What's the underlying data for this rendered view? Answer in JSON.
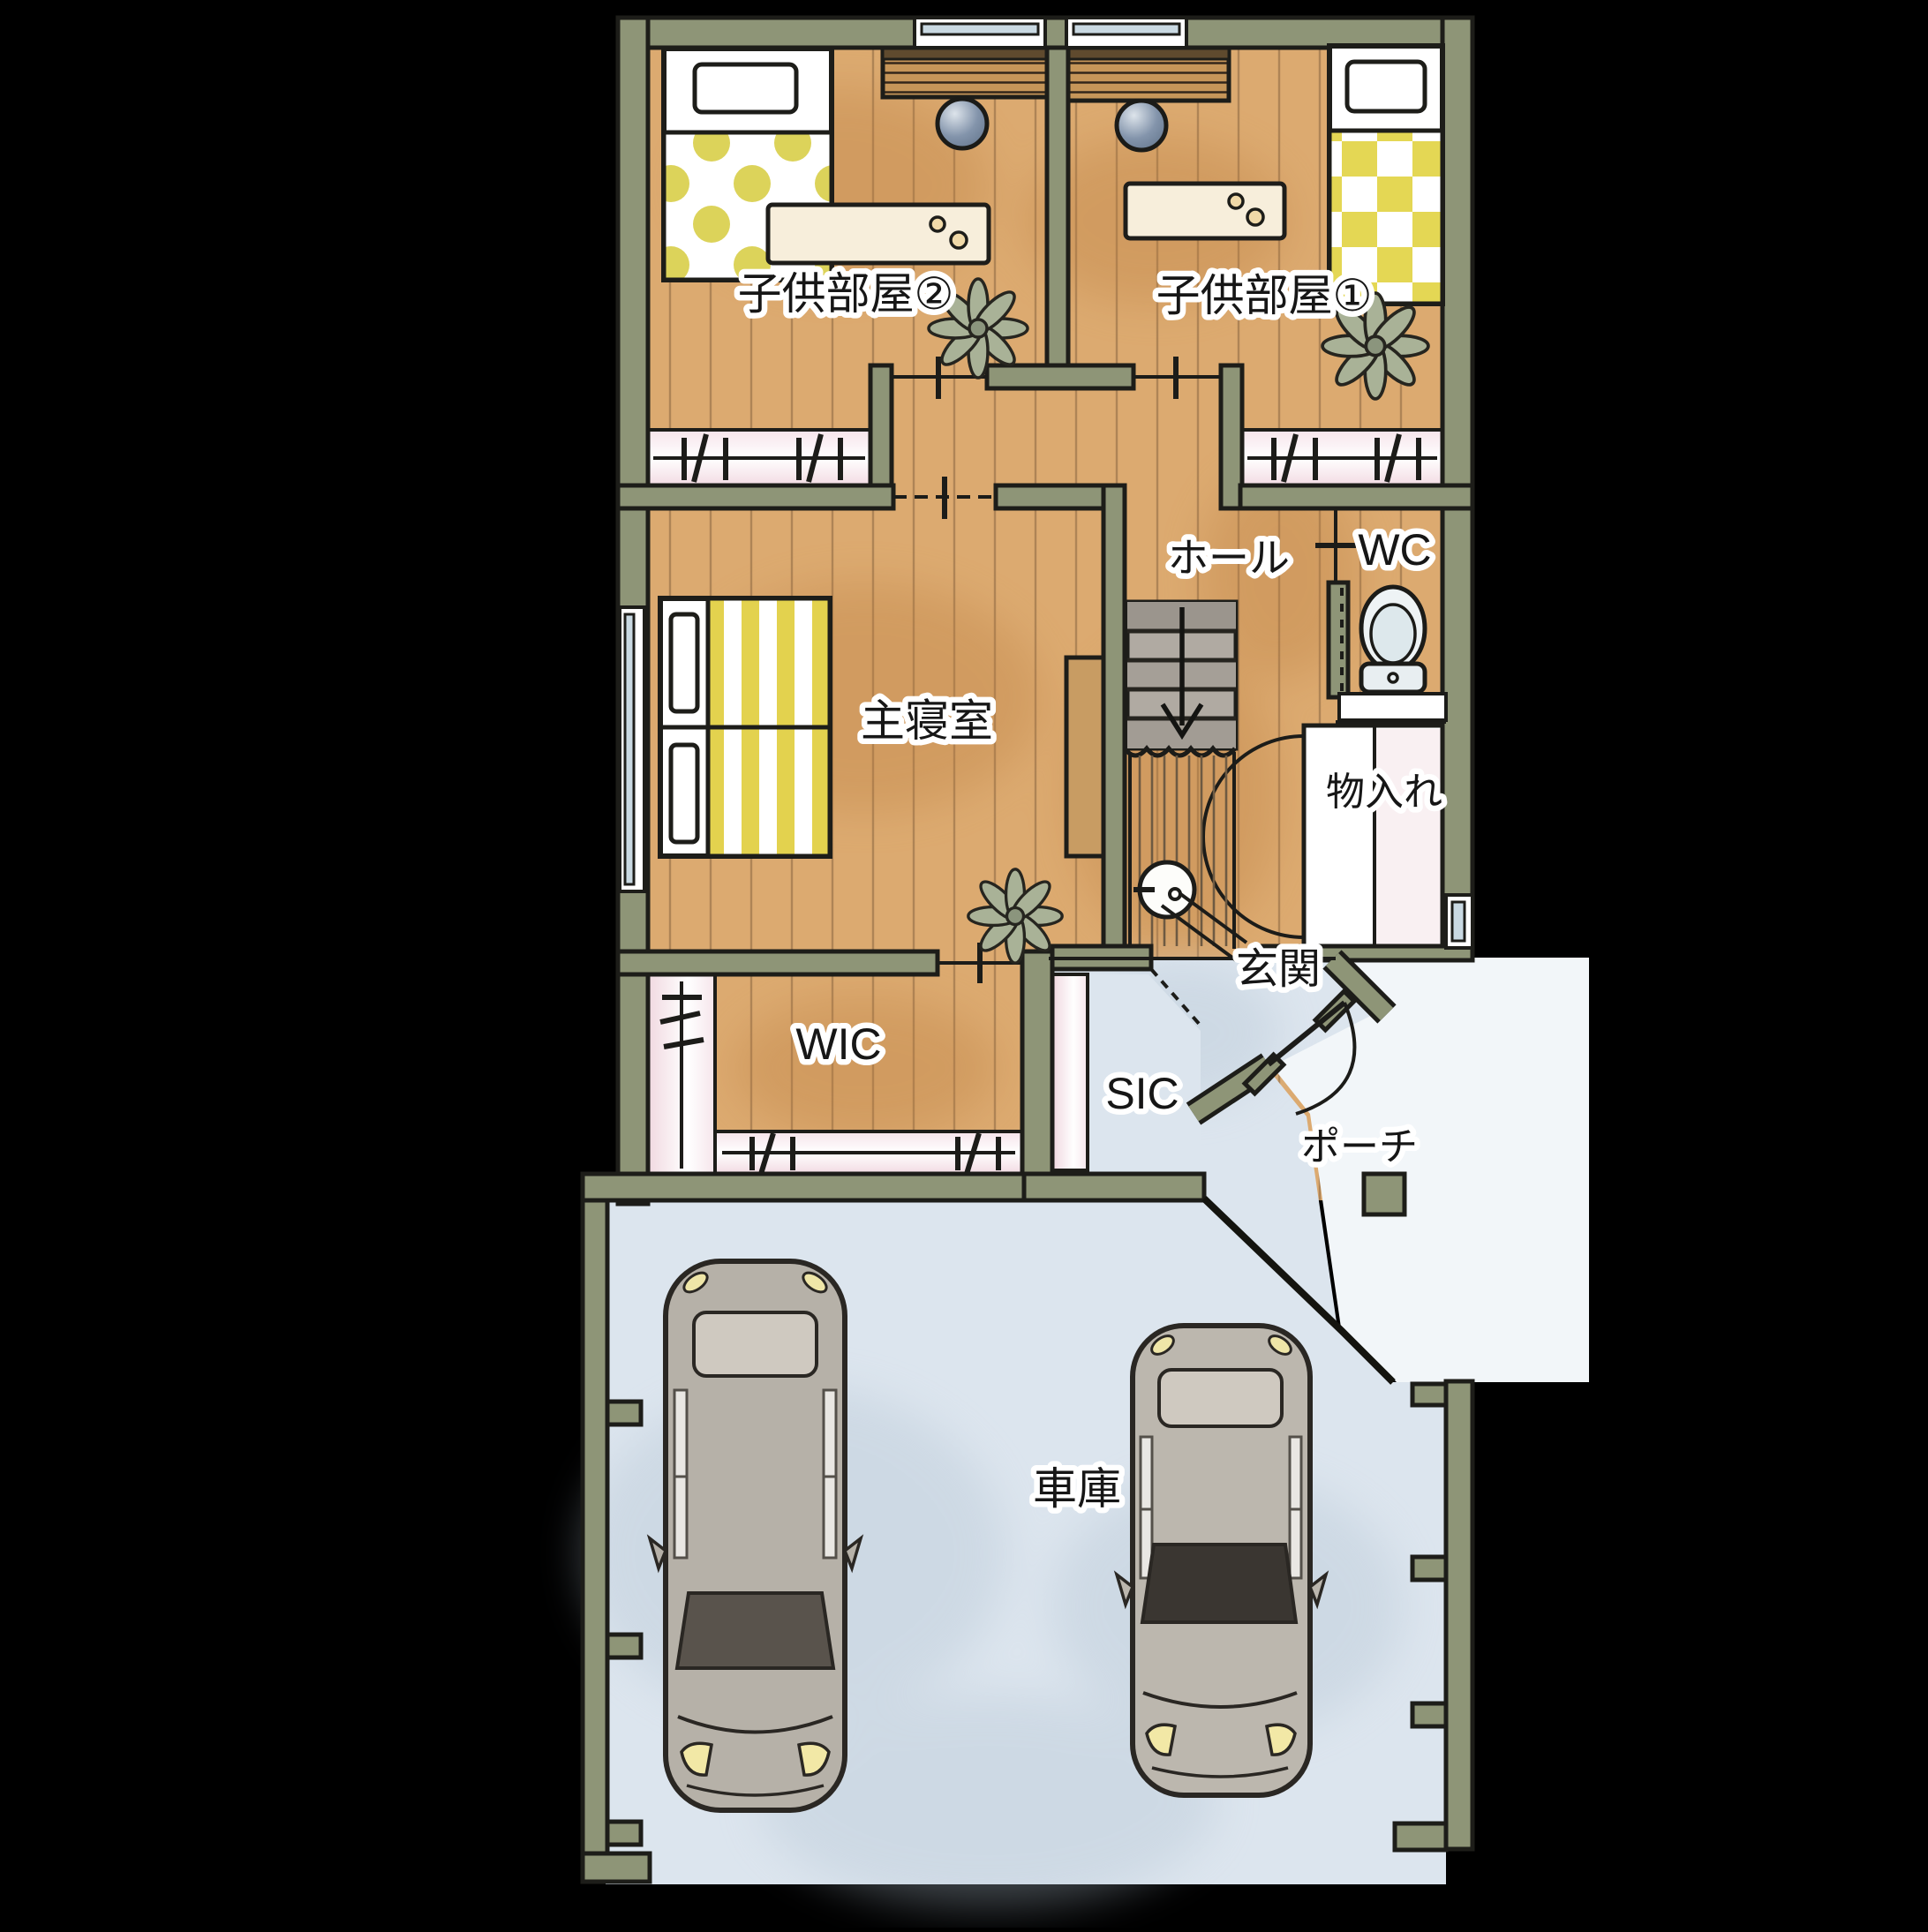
{
  "title": "手描き風 住宅間取り図（2階＋車庫）",
  "colors": {
    "background": "#000000",
    "wall_olive": "#8e9577",
    "wood_floor": "#dcaa70",
    "tile_blue": "#dce5ee",
    "porch_white": "#f2f6f9",
    "closet_pink": "#f3dce3",
    "bedding_yellow": "#e0d254",
    "stair_gray": "#b0aaa2",
    "ball_blue": "#8394ab",
    "plant_green": "#a9b297",
    "car_gray": "#b6b1a8"
  },
  "rooms": {
    "kids2": {
      "label": "子供部屋②"
    },
    "kids1": {
      "label": "子供部屋①"
    },
    "hall": {
      "label": "ホール"
    },
    "wc": {
      "label": "WC"
    },
    "master": {
      "label": "主寝室"
    },
    "storage": {
      "label": "物入れ"
    },
    "entrance": {
      "label": "玄関"
    },
    "wic": {
      "label": "WIC"
    },
    "sic": {
      "label": "SIC"
    },
    "porch": {
      "label": "ポーチ"
    },
    "garage": {
      "label": "車庫"
    }
  },
  "icons": {
    "ball": "blue-ball",
    "plant": "potted-plant",
    "toilet": "toilet-top-view",
    "car": "car-top-view",
    "stairs_down_arrow": "arrow-down"
  }
}
